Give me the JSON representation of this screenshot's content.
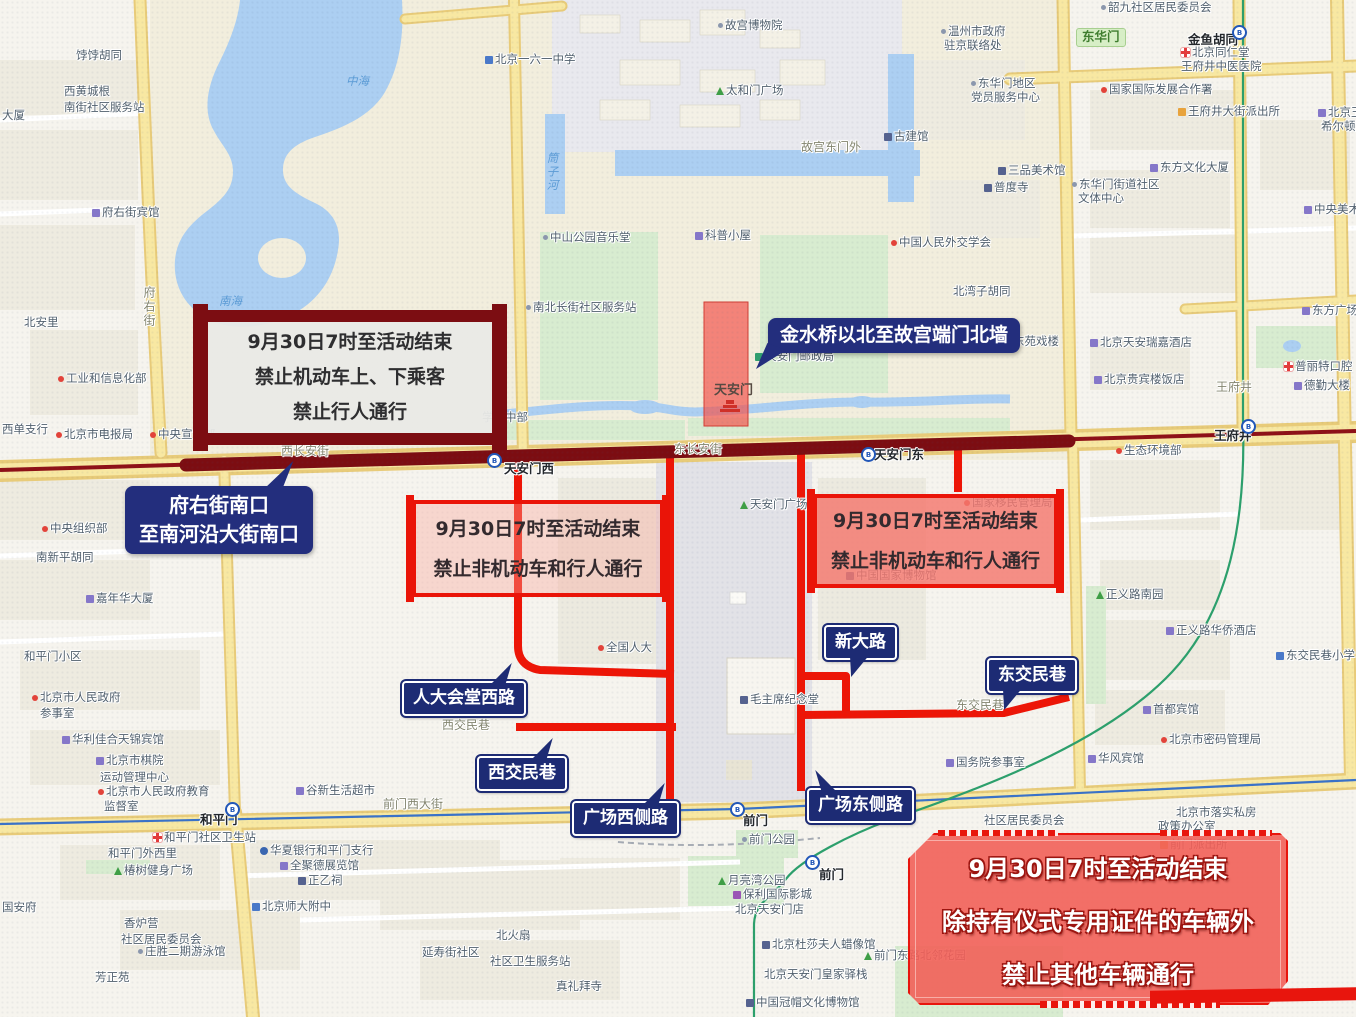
{
  "canvas": {
    "width": 1356,
    "height": 1017
  },
  "colors": {
    "closed_route": "#7c0d12",
    "restricted_route": "#ee1506",
    "callout_navy": "#1d2b74",
    "restriction_box_border": "#ea1408",
    "ceremony_box_fill": "#f26058",
    "road_yellow": "#f8e8a2",
    "water_blue": "#accff2",
    "park_green": "#d8ecd0"
  },
  "annotations": {
    "closure_box": {
      "lines": [
        "9月30日7时至活动结束",
        "禁止机动车上、下乘客",
        "禁止行人通行"
      ]
    },
    "fuyoujie_callout": {
      "lines": [
        "府右街南口",
        "至南河沿大街南口"
      ]
    },
    "jinshuiqiao_callout": {
      "text": "金水桥以北至故宫端门北墙"
    },
    "west_restriction_box": {
      "lines": [
        "9月30日7时至活动结束",
        "禁止非机动车和行人通行"
      ]
    },
    "east_restriction_box": {
      "lines": [
        "9月30日7时至活动结束",
        "禁止非机动车和行人通行"
      ]
    },
    "ceremony_box": {
      "lines": [
        "9月30日7时至活动结束",
        "除持有仪式专用证件的车辆外",
        "禁止其他车辆通行"
      ]
    },
    "road_callouts": [
      {
        "text": "人大会堂西路"
      },
      {
        "text": "西交民巷"
      },
      {
        "text": "广场西侧路"
      },
      {
        "text": "广场东侧路"
      },
      {
        "text": "新大路"
      },
      {
        "text": "东交民巷"
      }
    ]
  },
  "map_labels": [
    {
      "t": "饽饽胡同",
      "x": 76,
      "y": 50,
      "cls": "g"
    },
    {
      "t": "西黄城根",
      "x": 64,
      "y": 86,
      "cls": "g"
    },
    {
      "t": "南街社区服务站",
      "x": 64,
      "y": 102,
      "cls": "g"
    },
    {
      "t": "大厦",
      "x": 2,
      "y": 110,
      "cls": "g"
    },
    {
      "t": "府右街宾馆",
      "x": 92,
      "y": 207,
      "cls": "g",
      "ic": "bld"
    },
    {
      "t": "北安里",
      "x": 24,
      "y": 317,
      "cls": "g"
    },
    {
      "t": "工业和信息化部",
      "x": 58,
      "y": 373,
      "cls": "g",
      "ic": "dot"
    },
    {
      "t": "西单支行",
      "x": 2,
      "y": 424,
      "cls": "g"
    },
    {
      "t": "北京市电报局",
      "x": 56,
      "y": 429,
      "cls": "g",
      "ic": "dot"
    },
    {
      "t": "中央宣传部",
      "x": 150,
      "y": 429,
      "cls": "g",
      "ic": "dot"
    },
    {
      "t": "中央组织部",
      "x": 42,
      "y": 523,
      "cls": "g",
      "ic": "dot"
    },
    {
      "t": "南新平胡同",
      "x": 36,
      "y": 552,
      "cls": "g"
    },
    {
      "t": "嘉年华大厦",
      "x": 86,
      "y": 593,
      "cls": "g",
      "ic": "bld"
    },
    {
      "t": "和平门小区",
      "x": 24,
      "y": 651,
      "cls": "g"
    },
    {
      "t": "北京市人民政府",
      "x": 32,
      "y": 692,
      "cls": "g",
      "ic": "dot"
    },
    {
      "t": "参事室",
      "x": 40,
      "y": 708,
      "cls": "g"
    },
    {
      "t": "华利佳合天锦宾馆",
      "x": 62,
      "y": 734,
      "cls": "g",
      "ic": "bld"
    },
    {
      "t": "北京市棋院",
      "x": 96,
      "y": 755,
      "cls": "g",
      "ic": "bld"
    },
    {
      "t": "运动管理中心",
      "x": 100,
      "y": 772,
      "cls": "g"
    },
    {
      "t": "北京市人民政府教育",
      "x": 98,
      "y": 786,
      "cls": "g",
      "ic": "dot"
    },
    {
      "t": "监督室",
      "x": 104,
      "y": 801,
      "cls": "g"
    },
    {
      "t": "谷新生活超市",
      "x": 296,
      "y": 785,
      "cls": "g",
      "ic": "bld"
    },
    {
      "t": "国安府",
      "x": 2,
      "y": 902,
      "cls": "g"
    },
    {
      "t": "和平门社区卫生站",
      "x": 153,
      "y": 832,
      "cls": "g",
      "ic": "cross"
    },
    {
      "t": "和平门外西里",
      "x": 108,
      "y": 848,
      "cls": "g"
    },
    {
      "t": "椿树健身广场",
      "x": 114,
      "y": 865,
      "cls": "g",
      "ic": "tree"
    },
    {
      "t": "香炉营",
      "x": 124,
      "y": 918,
      "cls": "g"
    },
    {
      "t": "社区居民委员会",
      "x": 121,
      "y": 934,
      "cls": "g"
    },
    {
      "t": "庄胜二期游泳馆",
      "x": 138,
      "y": 946,
      "cls": "g",
      "ic": "dot2"
    },
    {
      "t": "芳正苑",
      "x": 95,
      "y": 972,
      "cls": "g"
    },
    {
      "t": "华夏银行和平门支行",
      "x": 260,
      "y": 845,
      "cls": "g",
      "ic": "bank"
    },
    {
      "t": "全聚德展览馆",
      "x": 280,
      "y": 860,
      "cls": "g",
      "ic": "bld"
    },
    {
      "t": "正乙祠",
      "x": 298,
      "y": 875,
      "cls": "g",
      "ic": "mus"
    },
    {
      "t": "北京师大附中",
      "x": 252,
      "y": 901,
      "cls": "g",
      "ic": "sch"
    },
    {
      "t": "老舍茶馆",
      "x": 576,
      "y": 827,
      "cls": "g",
      "ic": "dot2"
    },
    {
      "t": "前门公园",
      "x": 742,
      "y": 834,
      "cls": "g",
      "ic": "dot2"
    },
    {
      "t": "月亮湾公园",
      "x": 718,
      "y": 875,
      "cls": "g",
      "ic": "tree"
    },
    {
      "t": "保利国际影城",
      "x": 733,
      "y": 889,
      "cls": "g",
      "ic": "cin"
    },
    {
      "t": "北京天安门店",
      "x": 735,
      "y": 904,
      "cls": "g"
    },
    {
      "t": "北京杜莎夫人蜡像馆",
      "x": 762,
      "y": 939,
      "cls": "g",
      "ic": "mus"
    },
    {
      "t": "北京天安门皇家驿栈",
      "x": 764,
      "y": 969,
      "cls": "g"
    },
    {
      "t": "中国冠帽文化博物馆",
      "x": 746,
      "y": 997,
      "cls": "g",
      "ic": "mus"
    },
    {
      "t": "真礼拜寺",
      "x": 556,
      "y": 981,
      "cls": "g"
    },
    {
      "t": "北火扇",
      "x": 496,
      "y": 930,
      "cls": "g"
    },
    {
      "t": "延寿街社区",
      "x": 422,
      "y": 947,
      "cls": "g"
    },
    {
      "t": "社区卫生服务站",
      "x": 490,
      "y": 956,
      "cls": "g"
    },
    {
      "t": "前门东路北邻花园",
      "x": 864,
      "y": 950,
      "cls": "g",
      "ic": "tree"
    },
    {
      "t": "社区居民委员会",
      "x": 984,
      "y": 815,
      "cls": "g"
    },
    {
      "t": "北京市落实私房",
      "x": 1176,
      "y": 807,
      "cls": "g"
    },
    {
      "t": "政策办公室",
      "x": 1158,
      "y": 821,
      "cls": "g"
    },
    {
      "t": "前门派出所",
      "x": 1160,
      "y": 839,
      "cls": "g",
      "ic": "pol"
    },
    {
      "t": "国务院参事室",
      "x": 946,
      "y": 757,
      "cls": "g",
      "ic": "bld"
    },
    {
      "t": "华风宾馆",
      "x": 1088,
      "y": 753,
      "cls": "g",
      "ic": "bld"
    },
    {
      "t": "首都宾馆",
      "x": 1143,
      "y": 704,
      "cls": "g",
      "ic": "bld"
    },
    {
      "t": "北京市密码管理局",
      "x": 1161,
      "y": 734,
      "cls": "g",
      "ic": "dot"
    },
    {
      "t": "正义路南园",
      "x": 1096,
      "y": 589,
      "cls": "g",
      "ic": "tree"
    },
    {
      "t": "正义路华侨酒店",
      "x": 1166,
      "y": 625,
      "cls": "g",
      "ic": "bld"
    },
    {
      "t": "东交民巷小学",
      "x": 1276,
      "y": 650,
      "cls": "g",
      "ic": "sch"
    },
    {
      "t": "生态环境部",
      "x": 1116,
      "y": 445,
      "cls": "g",
      "ic": "dot"
    },
    {
      "t": "北京贵宾楼饭店",
      "x": 1094,
      "y": 374,
      "cls": "g",
      "ic": "bld"
    },
    {
      "t": "北京天安瑞嘉酒店",
      "x": 1090,
      "y": 337,
      "cls": "g",
      "ic": "bld"
    },
    {
      "t": "东方广场",
      "x": 1302,
      "y": 305,
      "cls": "g",
      "ic": "bld"
    },
    {
      "t": "普丽特口腔",
      "x": 1284,
      "y": 361,
      "cls": "g",
      "ic": "cross"
    },
    {
      "t": "德勤大楼",
      "x": 1294,
      "y": 380,
      "cls": "g",
      "ic": "bld"
    },
    {
      "t": "东方文化大厦",
      "x": 1150,
      "y": 162,
      "cls": "g",
      "ic": "bld"
    },
    {
      "t": "中央美术馆",
      "x": 1304,
      "y": 204,
      "cls": "g",
      "ic": "bld"
    },
    {
      "t": "韶九社区居民委员会",
      "x": 1101,
      "y": 2,
      "cls": "g",
      "ic": "dot2"
    },
    {
      "t": "北京同仁堂",
      "x": 1181,
      "y": 47,
      "cls": "g",
      "ic": "cross"
    },
    {
      "t": "王府井中医医院",
      "x": 1181,
      "y": 61,
      "cls": "g"
    },
    {
      "t": "国家国际发展合作署",
      "x": 1101,
      "y": 84,
      "cls": "g",
      "ic": "dot"
    },
    {
      "t": "王府井大街派出所",
      "x": 1178,
      "y": 106,
      "cls": "g",
      "ic": "pol"
    },
    {
      "t": "北京王府井",
      "x": 1318,
      "y": 107,
      "cls": "g",
      "ic": "bld"
    },
    {
      "t": "希尔顿酒店",
      "x": 1321,
      "y": 121,
      "cls": "g"
    },
    {
      "t": "温州市政府",
      "x": 941,
      "y": 26,
      "cls": "g",
      "ic": "dot2"
    },
    {
      "t": "驻京联络处",
      "x": 944,
      "y": 40,
      "cls": "g"
    },
    {
      "t": "东华门地区",
      "x": 971,
      "y": 78,
      "cls": "g",
      "ic": "dot2"
    },
    {
      "t": "党员服务中心",
      "x": 971,
      "y": 92,
      "cls": "g"
    },
    {
      "t": "三品美术馆",
      "x": 998,
      "y": 165,
      "cls": "g",
      "ic": "mus"
    },
    {
      "t": "普度寺",
      "x": 984,
      "y": 182,
      "cls": "g",
      "ic": "mus"
    },
    {
      "t": "东华门街道社区",
      "x": 1072,
      "y": 179,
      "cls": "g",
      "ic": "dot2"
    },
    {
      "t": "文体中心",
      "x": 1078,
      "y": 193,
      "cls": "g"
    },
    {
      "t": "中国人民外交学会",
      "x": 891,
      "y": 237,
      "cls": "g",
      "ic": "dot"
    },
    {
      "t": "北湾子胡同",
      "x": 953,
      "y": 286,
      "cls": "g"
    },
    {
      "t": "东苑戏楼",
      "x": 1003,
      "y": 336,
      "cls": "g",
      "ic": "mus"
    },
    {
      "t": "北京一六一中学",
      "x": 485,
      "y": 54,
      "cls": "g",
      "ic": "sch"
    },
    {
      "t": "故宫博物院",
      "x": 718,
      "y": 20,
      "cls": "g",
      "ic": "dot2"
    },
    {
      "t": "太和门广场",
      "x": 716,
      "y": 85,
      "cls": "g",
      "ic": "tree"
    },
    {
      "t": "故宫东门外",
      "x": 801,
      "y": 141,
      "cls": "st"
    },
    {
      "t": "古建馆",
      "x": 884,
      "y": 131,
      "cls": "g",
      "ic": "mus"
    },
    {
      "t": "中山公园音乐堂",
      "x": 543,
      "y": 232,
      "cls": "g",
      "ic": "dot2"
    },
    {
      "t": "科普小屋",
      "x": 695,
      "y": 230,
      "cls": "g",
      "ic": "bld"
    },
    {
      "t": "南北长街社区服务站",
      "x": 526,
      "y": 302,
      "cls": "g",
      "ic": "dot2"
    },
    {
      "t": "天安门邮政局",
      "x": 755,
      "y": 351,
      "cls": "g",
      "ic": "post"
    },
    {
      "t": "天安门",
      "x": 714,
      "y": 384,
      "cls": "tam"
    },
    {
      "t": "学高中部",
      "x": 482,
      "y": 412,
      "cls": "g"
    },
    {
      "t": "天安门广场",
      "x": 740,
      "y": 499,
      "cls": "g",
      "ic": "tree"
    },
    {
      "t": "全国人大",
      "x": 598,
      "y": 642,
      "cls": "g",
      "ic": "dot"
    },
    {
      "t": "毛主席纪念堂",
      "x": 740,
      "y": 694,
      "cls": "g",
      "ic": "mus"
    },
    {
      "t": "中国国家博物馆",
      "x": 846,
      "y": 570,
      "cls": "g",
      "ic": "mus"
    },
    {
      "t": "国家移民管理局",
      "x": 964,
      "y": 497,
      "cls": "g",
      "ic": "dot"
    },
    {
      "t": "西长安街",
      "x": 281,
      "y": 445,
      "cls": "st"
    },
    {
      "t": "东长安街",
      "x": 674,
      "y": 443,
      "cls": "st"
    },
    {
      "t": "西交民巷",
      "x": 442,
      "y": 719,
      "cls": "st"
    },
    {
      "t": "东交民巷",
      "x": 956,
      "y": 699,
      "cls": "st"
    },
    {
      "t": "前门西大街",
      "x": 383,
      "y": 798,
      "cls": "st"
    },
    {
      "t": "王府井",
      "x": 1216,
      "y": 381,
      "cls": "st"
    },
    {
      "t": "府右街",
      "x": 143,
      "y": 286,
      "cls": "st",
      "vert": true
    },
    {
      "t": "筒子河",
      "x": 546,
      "y": 152,
      "cls": "water",
      "vert": true
    },
    {
      "t": "中海",
      "x": 346,
      "y": 76,
      "cls": "water"
    },
    {
      "t": "南海",
      "x": 219,
      "y": 296,
      "cls": "water"
    },
    {
      "t": "天安门西",
      "x": 504,
      "y": 463,
      "cls": "stn"
    },
    {
      "t": "天安门东",
      "x": 874,
      "y": 449,
      "cls": "stn"
    },
    {
      "t": "王府井",
      "x": 1214,
      "y": 430,
      "cls": "stn"
    },
    {
      "t": "金鱼胡同",
      "x": 1188,
      "y": 34,
      "cls": "stn"
    },
    {
      "t": "和平门",
      "x": 200,
      "y": 814,
      "cls": "stn"
    },
    {
      "t": "前门",
      "x": 743,
      "y": 815,
      "cls": "stn"
    },
    {
      "t": "前门",
      "x": 819,
      "y": 869,
      "cls": "stn"
    },
    {
      "t": "东华门",
      "x": 1076,
      "y": 28,
      "cls": "badge"
    }
  ],
  "subway_stations": [
    {
      "x": 493,
      "y": 459
    },
    {
      "x": 867,
      "y": 453
    },
    {
      "x": 1247,
      "y": 425
    },
    {
      "x": 1238,
      "y": 31
    },
    {
      "x": 231,
      "y": 808
    },
    {
      "x": 736,
      "y": 808
    },
    {
      "x": 811,
      "y": 861
    }
  ]
}
